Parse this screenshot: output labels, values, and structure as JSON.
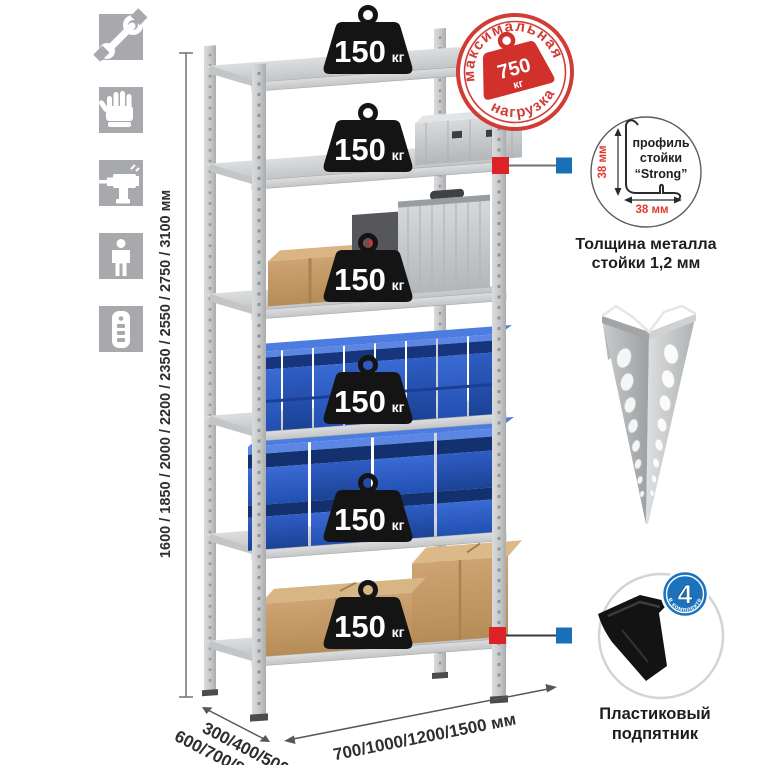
{
  "assembly_icons": [
    {
      "icon": "wrench-icon"
    },
    {
      "icon": "gloves-icon"
    },
    {
      "icon": "drill-icon"
    },
    {
      "icon": "person-icon"
    },
    {
      "icon": "post-profile-icon"
    }
  ],
  "dimensions": {
    "height": {
      "label": "1600 / 1850 / 2000 / 2200 / 2350 / 2550 / 2750 / 3100 мм"
    },
    "depth": {
      "line1": "300/400/500",
      "line2": "600/700/800 мм"
    },
    "width": {
      "label": "700/1000/1200/1500 мм"
    }
  },
  "shelf_loads": [
    {
      "value": "150",
      "unit": "кг"
    },
    {
      "value": "150",
      "unit": "кг"
    },
    {
      "value": "150",
      "unit": "кг"
    },
    {
      "value": "150",
      "unit": "кг"
    },
    {
      "value": "150",
      "unit": "кг"
    },
    {
      "value": "150",
      "unit": "кг"
    }
  ],
  "max_load_stamp": {
    "arc_top": "максимальная",
    "arc_bottom": "нагрузка",
    "value": "750",
    "unit": "кг"
  },
  "profile_detail": {
    "label_line1": "профиль",
    "label_line2": "стойки",
    "label_line3": "“Strong”",
    "height_dim": "38 мм",
    "width_dim": "38 мм",
    "caption_line1": "Толщина металла",
    "caption_line2": "стойки 1,2 мм"
  },
  "foot_detail": {
    "badge_number": "4",
    "badge_arc": "в комплекте",
    "caption_line1": "Пластиковый",
    "caption_line2": "подпятник"
  },
  "colors": {
    "stamp_red": "#d23c36",
    "dim_red": "#e03a30",
    "marker_red": "#dc2127",
    "marker_blue": "#1a70b8",
    "badge_blue": "#1a73bc",
    "bin_blue": "#2e5fc8",
    "metal_gray": "#c9cbcd",
    "cardboard": "#c59a67",
    "weight_black": "#141414",
    "icon_square_gray": "#a7a9ac"
  }
}
